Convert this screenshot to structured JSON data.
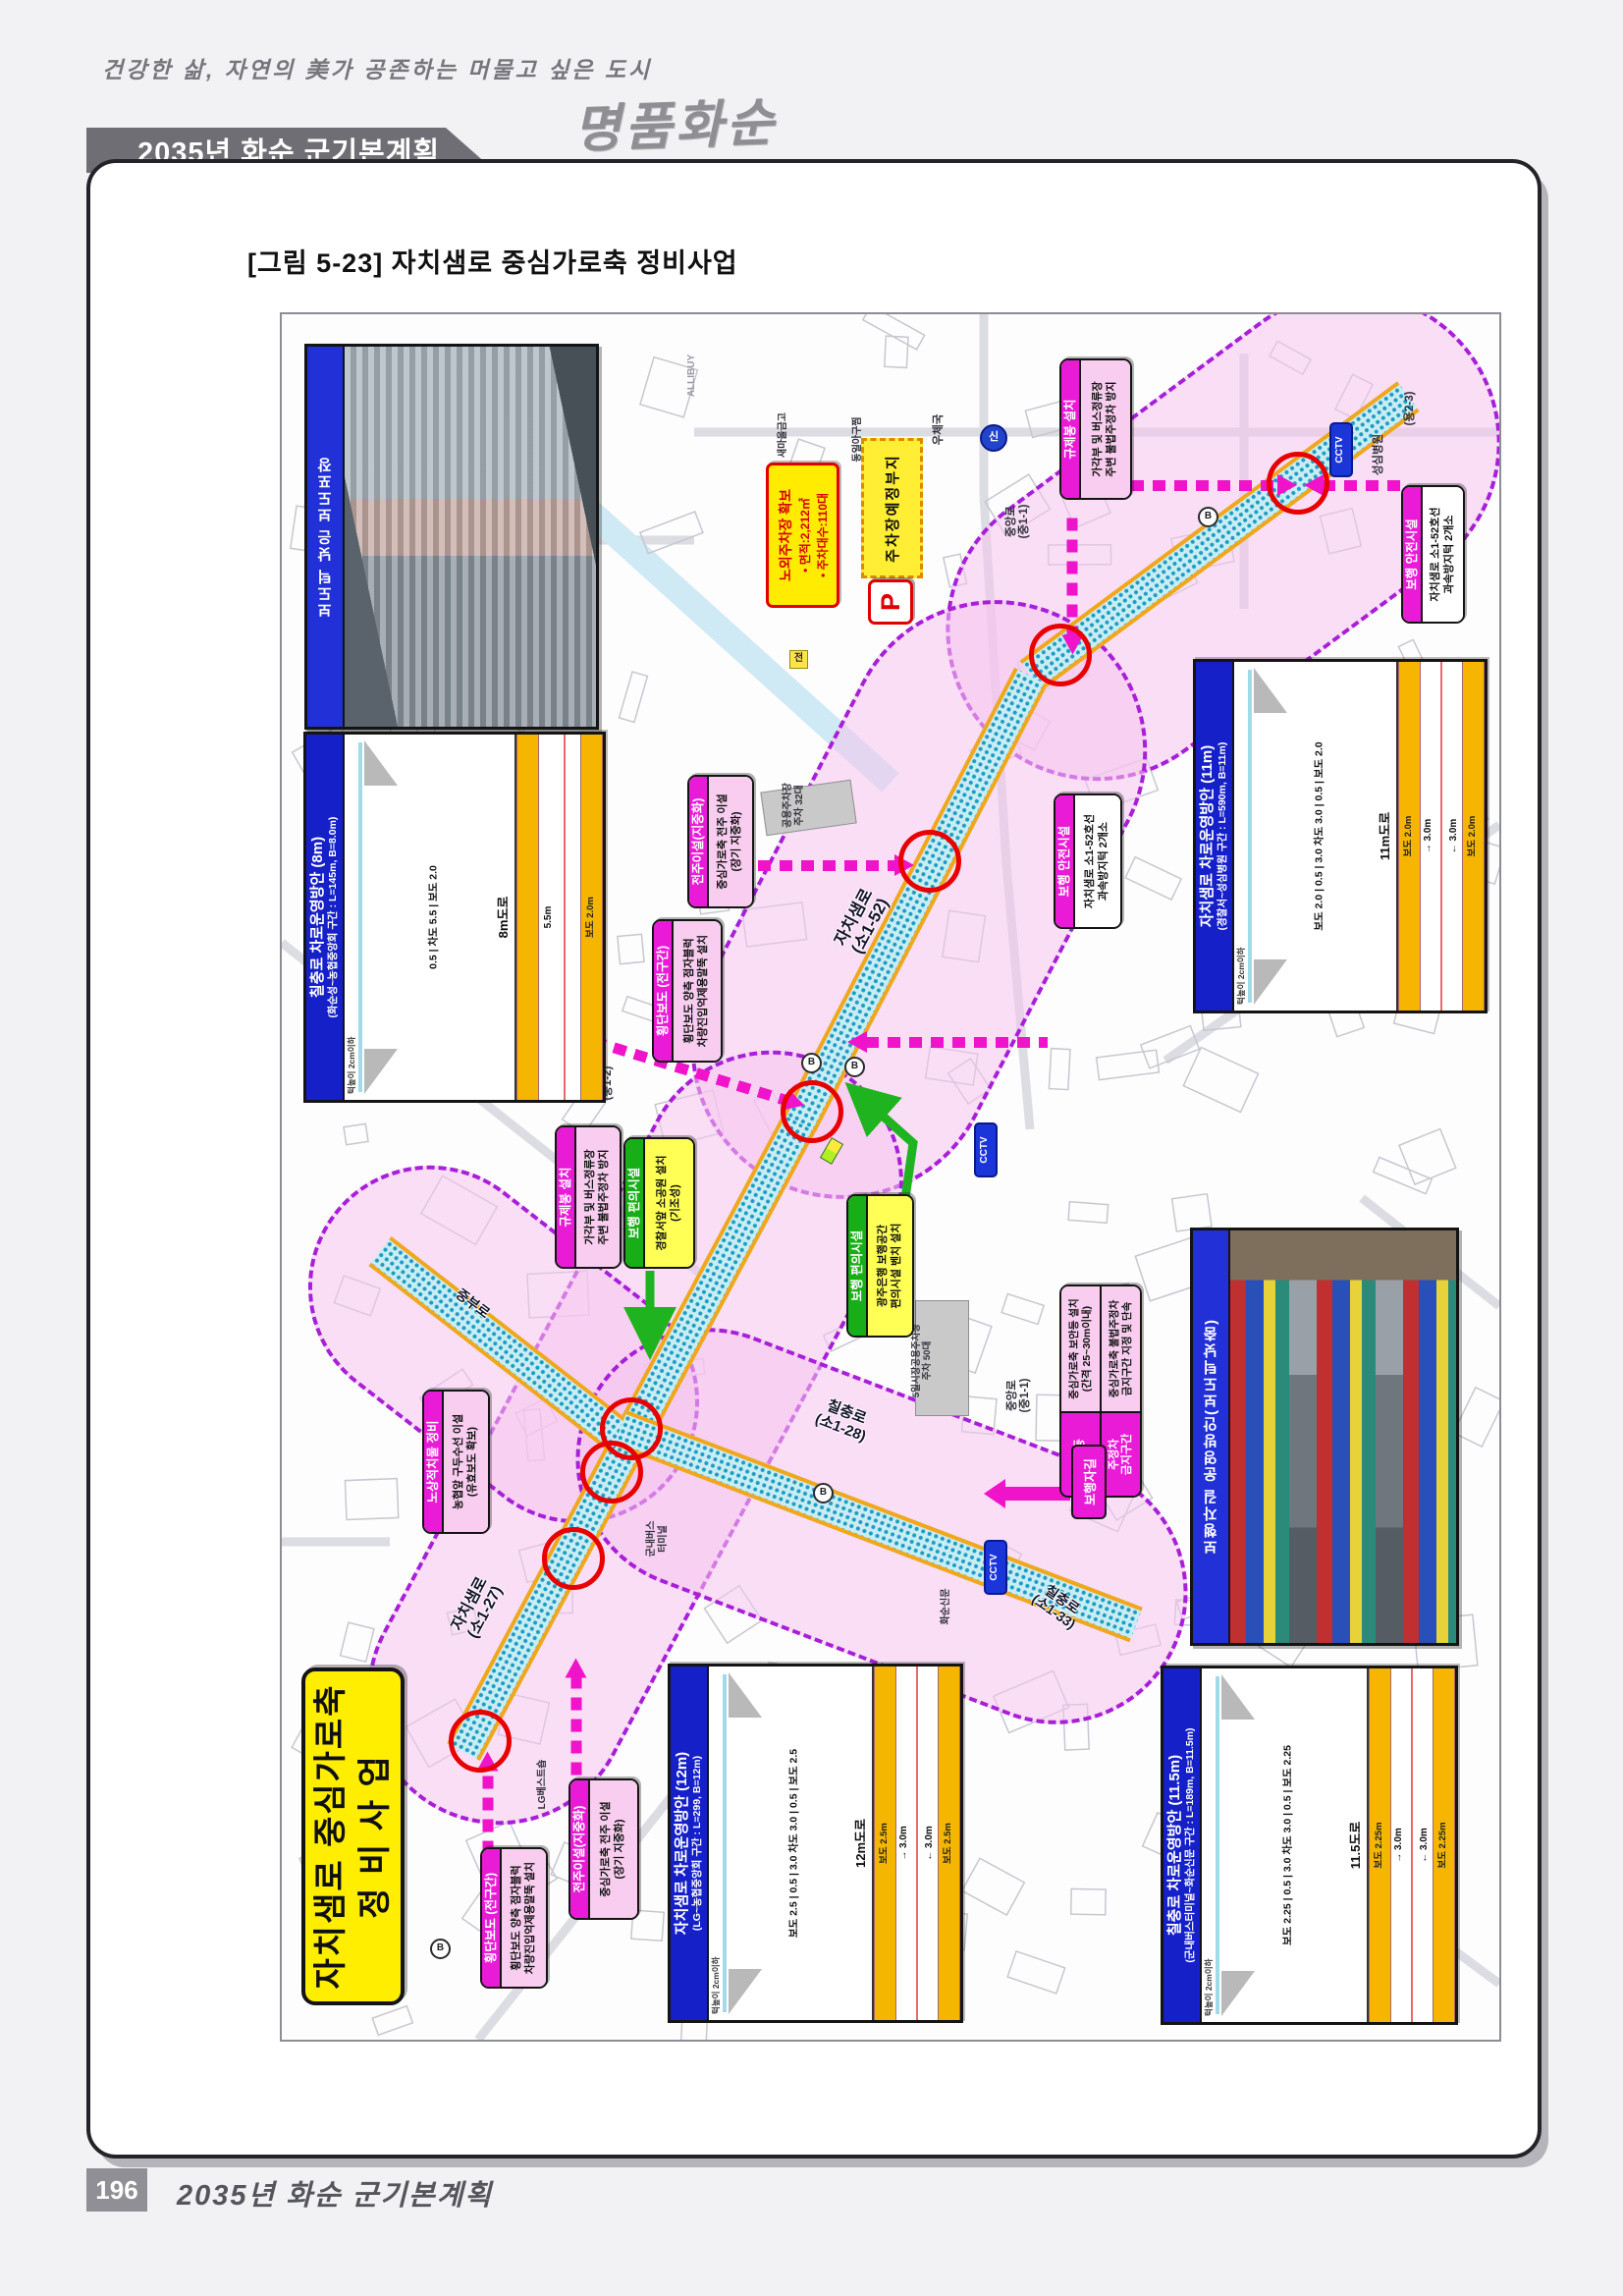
{
  "header": {
    "slogan": "건강한 삶, 자연의 美가 공존하는 머물고 싶은 도시",
    "banner_title": "2035년 화순 군기본계획",
    "logo": "명품화순"
  },
  "figure": {
    "caption": "[그림 5-23] 자치샘로 중심가로축 정비사업"
  },
  "footer": {
    "page_number": "196",
    "title": "2035년 화순 군기본계획"
  },
  "map": {
    "project_title": {
      "line1": "자치샘로 중심가로축",
      "line2": "정 비 사 업"
    },
    "photo1_label": "보도턱 낮은 보도포장",
    "photo2_label": "보행자길 운영방안(보도턱낮춤)",
    "parking": {
      "title": "노외주차장 확보",
      "area": "• 면적:2,212㎡",
      "count": "• 주차대수:110대"
    },
    "parking_site": "주차장예정부지",
    "p_symbol": "P",
    "callouts": {
      "reg_post": {
        "header": "규제봉 설치",
        "body": "가각부 및 버스정류장\n주변 불법주정차 방지"
      },
      "ped_safety": {
        "header": "보행 안전시설",
        "body": "자치샘로 소1-52호선\n과속방지턱 2개소"
      },
      "pole_reloc": {
        "header": "전주이설(지중화)",
        "body": "중심가로축 전주 이설\n(장기 지중화)"
      },
      "crosswalk": {
        "header": "횡단보도 (전구간)",
        "body": "횡단보도 양측 점자블럭\n차량진입억제용말뚝 설치"
      },
      "ped_conv_bank": {
        "header": "보행 편의시설",
        "body": "광주은행 보행공간\n편의시설 벤치 설치"
      },
      "ped_conv_police": {
        "header": "보행 편의시설",
        "body": "경찰서앞 소공원 설치\n(기조성)"
      },
      "street_clear": {
        "header": "노상적치물 정비",
        "body": "농협앞 구두수선 이설\n(유효보도 확보)"
      },
      "security_light": {
        "header": "보안등",
        "body": "중심가로축 보안등 설치\n(간격 25~30m이내)"
      },
      "no_parking": {
        "header": "주정차\n금지구간",
        "body": "중심가로축 불법주정차\n금지구간 지정 및 단속"
      },
      "ped_path_tag": "보행자길"
    },
    "roads": {
      "jachisaem_52": "자치샘로\n(소1-52)",
      "jachisaem_27": "자치샘로\n(소1-27)",
      "chilchung_28": "칠충로\n(소1-28)",
      "chilchung_33": "칠충로\n(소1-33)",
      "jungang_11": "중앙로\n(중1-1)",
      "jungang_12": "중앙로\n(중1-2)",
      "jungbu": "중부로",
      "yong23": "(용2-3)"
    },
    "pois": {
      "post_office": "우체국",
      "saemaul": "새마을금고",
      "dongil": "동일아구찜",
      "hospital": "성심병원",
      "bus_terminal": "군내버스\n터미널",
      "lg_shop": "LG베스트숍",
      "newspaper": "화순신문",
      "parking32": "공용주차장\n주차 32대",
      "parking50": "5일시장공용주차장\n주차 50대",
      "cctv": "CCTV",
      "signal": "신",
      "bus_stop": "B",
      "jeon": "전",
      "allibuy": "ALLIBUY"
    },
    "panels": [
      {
        "title": "칠충로 차로운영방안 (8m)",
        "subtitle": "(화순성~농협중앙회 구간 : L=145m, B=8.0m)",
        "dims": "0.5 | 차도 5.5 | 보도 2.0",
        "road": "8m도로",
        "note": "턱높이 2cm이하",
        "walk_top": "",
        "lane_up": "5.5m",
        "lane_down": "",
        "walk_bottom": "보도 2.0m"
      },
      {
        "title": "자치샘로 차로운영방안 (11m)",
        "subtitle": "(경찰서~성심병원 구간 : L=590m, B=11m)",
        "dims": "보도 2.0 | 0.5 | 3.0 차도 3.0 | 0.5 | 보도 2.0",
        "road": "11m도로",
        "note": "턱높이 2cm이하",
        "walk_top": "보도 2.0m",
        "lane_up": "→  3.0m",
        "lane_down": "←  3.0m",
        "walk_bottom": "보도 2.0m"
      },
      {
        "title": "자치샘로 차로운영방안 (12m)",
        "subtitle": "(LG~농협중앙회 구간 : L=299, B=12m)",
        "dims": "보도 2.5 | 0.5 | 3.0 차도 3.0 | 0.5 | 보도 2.5",
        "road": "12m도로",
        "note": "턱높이 2cm이하",
        "walk_top": "보도 2.5m",
        "lane_up": "→  3.0m",
        "lane_down": "←  3.0m",
        "walk_bottom": "보도 2.5m"
      },
      {
        "title": "칠충로 차로운영방안 (11.5m)",
        "subtitle": "(군내버스터미널~화순신문 구간 : L=189m, B=11.5m)",
        "dims": "보도 2.25 | 0.5 | 3.0 차도 3.0 | 0.5 | 보도 2.25",
        "road": "11.5도로",
        "note": "턱높이 2cm이하",
        "walk_top": "보도 2.25m",
        "lane_up": "→  3.0m",
        "lane_down": "←  3.0m",
        "walk_bottom": "보도 2.25m"
      }
    ]
  }
}
